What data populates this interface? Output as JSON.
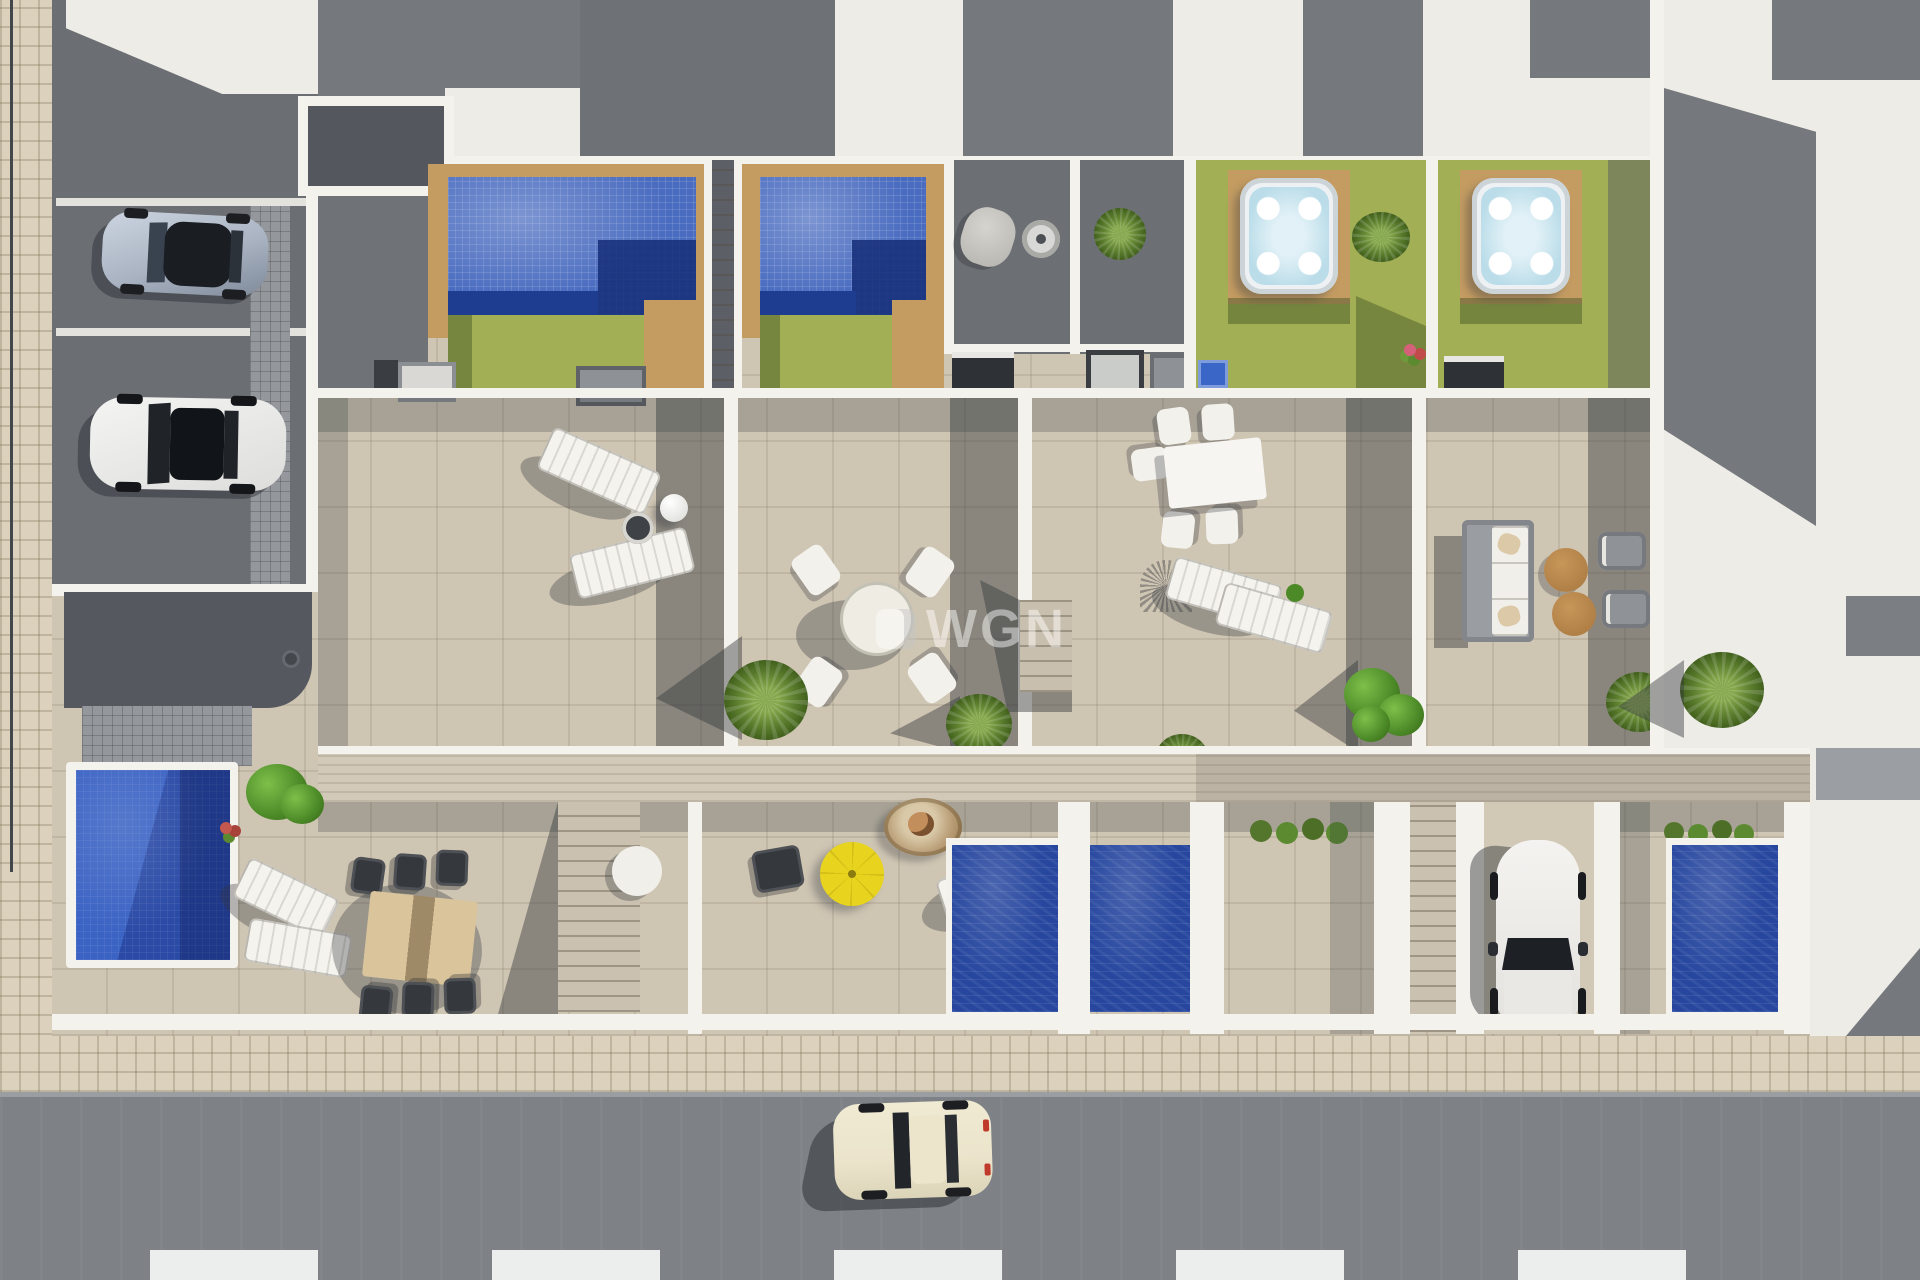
{
  "watermark": {
    "text": "WGN"
  },
  "scene": {
    "description": "Aerial top-down 3D architectural render of a row of four townhouses with roof gardens, private mosaic pools, hot tubs, tiled terraces, a parking court, garden pools, a driveway and a street"
  },
  "palette": {
    "beige": "#cfc5b3",
    "sidewalk": "#dbd1bc",
    "whiteroof": "#eeece6",
    "whitewall": "#f4f2ec",
    "graydark": "#6b6e73",
    "graymed": "#83868b",
    "graypave": "#94979b",
    "roofshadow": "#75787d",
    "poolblue": "#4a6cc0",
    "poolnavy": "#1e3c90",
    "pooldeep": "#27479f",
    "lawn": "#a3af55",
    "lawndark": "#77863e",
    "wood": "#c49c62",
    "walkway": "#d2c9b9",
    "road": "#7e8186",
    "tubwater": "#bbdde9",
    "yellow": "#e8d41f",
    "brown": "#b08047",
    "carsilver": "#a9b3c2",
    "carcream": "#ebe4cb"
  },
  "objects": {
    "vehicles": [
      "silver sports car in parking court",
      "white car with black roof in parking court",
      "white car on driveway",
      "cream classic car on street"
    ],
    "water_features": [
      "mosaic roof pool unit 1",
      "mosaic roof pool unit 2",
      "hot tub unit 3",
      "hot tub unit 4",
      "navy garden pool A",
      "navy garden pool B",
      "navy garden pool C",
      "corner pool bottom-left"
    ],
    "furniture": [
      "sun loungers with ball lamp",
      "round dining set with four chairs",
      "white dining table with chairs",
      "lounge sofa with brown poufs and chairs",
      "hanging egg chair",
      "yellow parasol",
      "outdoor kitchen counters",
      "wooden dining table with six dark chairs"
    ],
    "landscape": [
      "lawn strips",
      "wooden pool decks",
      "wooden walkway band",
      "palms and leafy plants",
      "tiled sidewalk",
      "crosswalk bars"
    ]
  }
}
